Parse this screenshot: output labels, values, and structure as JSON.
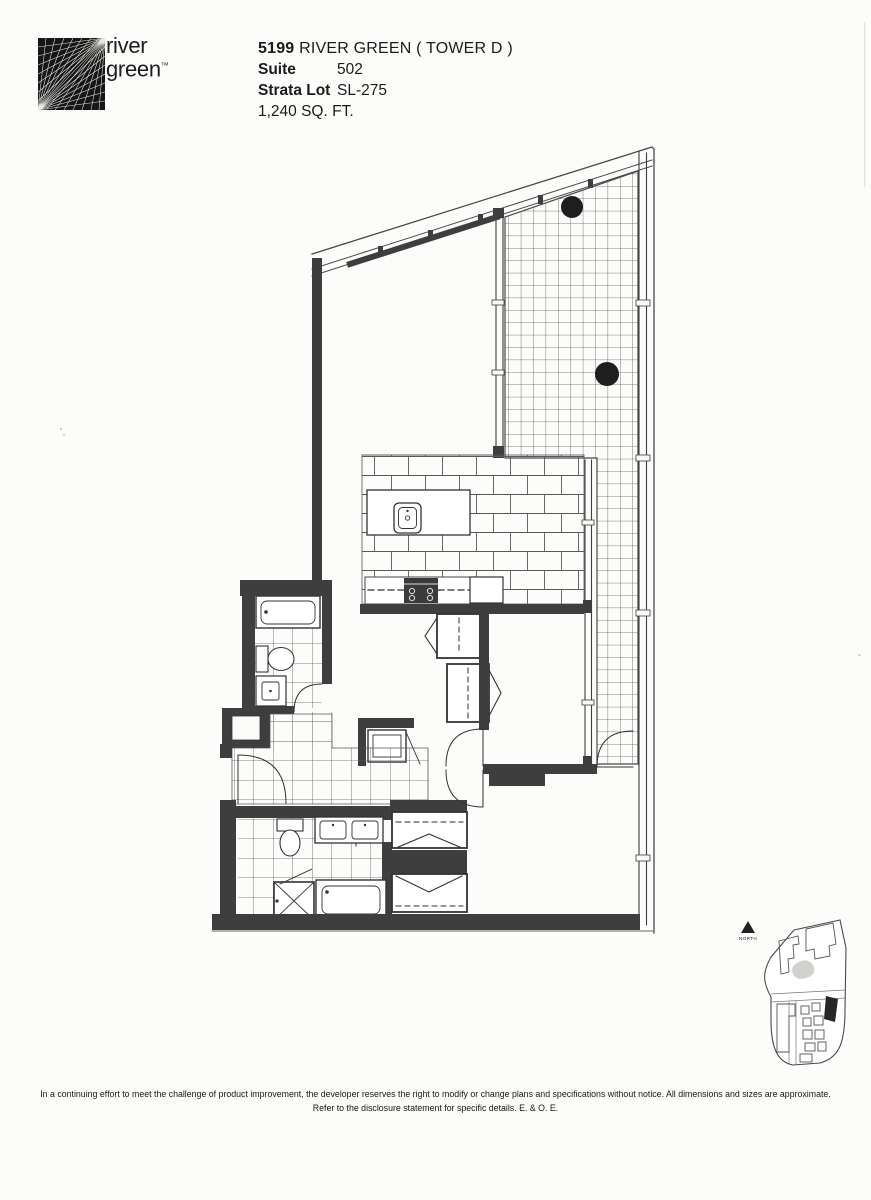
{
  "page": {
    "background": "#fcfcfa",
    "ink": "#1b1b1b",
    "wall_color": "#3e3e3e",
    "accent_black": "#1e1e1e"
  },
  "logo": {
    "word1": "river",
    "word2": "green",
    "trademark": "™"
  },
  "header": {
    "project_number": "5199",
    "project_title": "RIVER GREEN ( TOWER D )",
    "suite_label": "Suite",
    "suite_value": "502",
    "strata_label": "Strata Lot",
    "strata_value": "SL-275",
    "area_text": "1,240 SQ. FT."
  },
  "keymap": {
    "north_label": "NORTH"
  },
  "disclaimer": {
    "line1": "In a continuing effort to meet the challenge of product improvement, the developer reserves the right to modify or change plans and specifications without notice. All dimensions and sizes are approximate.",
    "line2": "Refer to the disclosure statement for specific details. E. & O. E."
  }
}
